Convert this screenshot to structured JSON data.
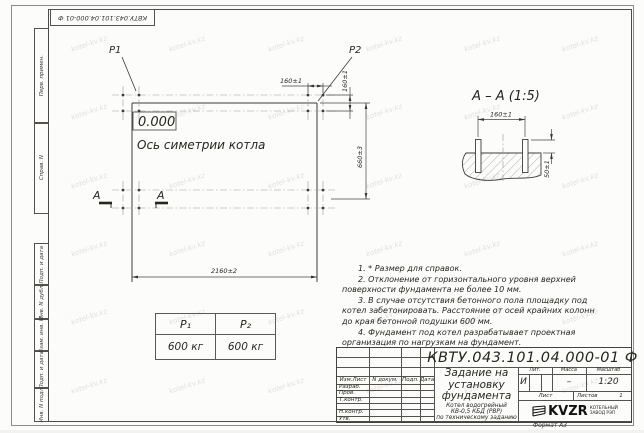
{
  "watermark": {
    "text": "kotel-kv.kz"
  },
  "frame": {
    "top_stamp": "КВТУ.043.101.04.000-01 Ф",
    "margin_labels": [
      "Перв. примен.",
      "Справ. N",
      "Подп. и дата",
      "Инв. N дубл.",
      "Взам. инв. N",
      "Подп. и дата",
      "Инв. N подл."
    ],
    "format_label": "Формат А3"
  },
  "plan": {
    "p1_label": "P1",
    "p2_label": "P2",
    "level_mark": "0.000",
    "axis_label": "Ось симетрии котла",
    "section_letter_left": "А",
    "section_letter_right": "А",
    "dim_bolt_spacing_h": "160±1",
    "dim_bolt_spacing_v": "160±1",
    "dim_width": "660±3",
    "dim_length": "2160±2"
  },
  "section": {
    "title": "А – А (1:5)",
    "dim_spacing": "160±1",
    "dim_protrusion": "50±1"
  },
  "loads_table": {
    "headers": [
      "P₁",
      "P₂"
    ],
    "values": [
      "600 кг",
      "600 кг"
    ]
  },
  "notes": [
    "1. * Размер для справок.",
    "2. Отклонение от горизонтального уровня верхней поверхности фундамента не более 10 мм.",
    "3. В случае отсутствия бетонного пола площадку под котел забетонировать. Расстояние от осей крайних колонн до края бетонной подушки 600 мм.",
    "4. Фундамент под котел разрабатывает проектная организация по нагрузкам на фундамент."
  ],
  "title_block": {
    "doc_number": "КВТУ.043.101.04.000-01 Ф",
    "title_lines": [
      "Задание на",
      "установку",
      "фундамента"
    ],
    "subtitle_lines": [
      "Котел водогрейный",
      "КВ-0,5 КБД (РВР)",
      "по техническому заданию"
    ],
    "col_headers": [
      "Изм.Лист",
      "N докум.",
      "Подп.",
      "Дата"
    ],
    "row_labels": [
      "Разраб.",
      "Пров.",
      "Т.контр.",
      "",
      "Н.контр.",
      "Утв."
    ],
    "lit_header": "Лит.",
    "mass_header": "Масса",
    "scale_header": "Масштаб",
    "lit_value": "И",
    "mass_value": "–",
    "scale_value": "1:20",
    "sheet_label": "Лист",
    "sheets_label": "Листов",
    "sheets_value": "1",
    "logo_text": "KVZR",
    "logo_caption_lines": [
      "КОТЕЛЬНЫЙ",
      "ЗАВОД РЭП"
    ]
  }
}
